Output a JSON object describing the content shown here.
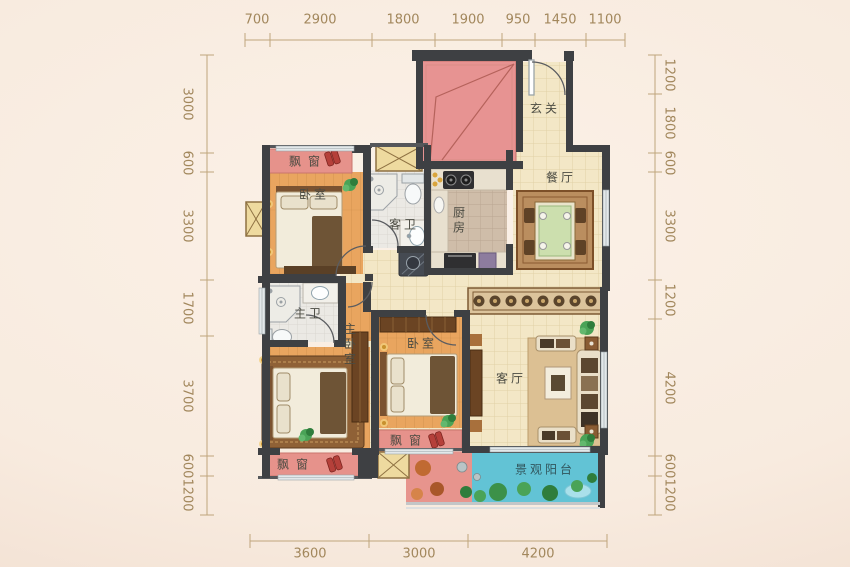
{
  "dimensions": {
    "top": [
      "700",
      "2900",
      "1800",
      "1900",
      "950",
      "1450",
      "1100"
    ],
    "left": [
      "3000",
      "600",
      "3300",
      "1700",
      "3700",
      "600",
      "1200"
    ],
    "right": [
      "1200",
      "1800",
      "600",
      "3300",
      "1200",
      "4200",
      "600",
      "1200"
    ],
    "bottom": [
      "3600",
      "3000",
      "4200"
    ]
  },
  "rooms": {
    "bedroom_top": {
      "label": "卧室"
    },
    "guest_bathroom": {
      "label": "客卫"
    },
    "kitchen": {
      "label": "厨房"
    },
    "dining_room": {
      "label": "餐厅"
    },
    "entry": {
      "label": "玄关"
    },
    "master_bathroom": {
      "label": "主卫"
    },
    "master_bedroom": {
      "label": "主卧室"
    },
    "bedroom_middle": {
      "label": "卧室"
    },
    "living_room": {
      "label": "客厅"
    },
    "balcony": {
      "label": "景观阳台"
    }
  },
  "features": {
    "bay_window_label": "飘窗"
  },
  "colors": {
    "background": "#f8ebdf",
    "wall": "#3e4043",
    "wood_floor": "#e9a55f",
    "tile_floor": "#f3e7c6",
    "bay_window": "#e6928b",
    "red_block": "#e79392",
    "balcony_water": "#62c3d5",
    "balcony_plants": "#4aa357",
    "dimension_text": "#a2875c"
  }
}
